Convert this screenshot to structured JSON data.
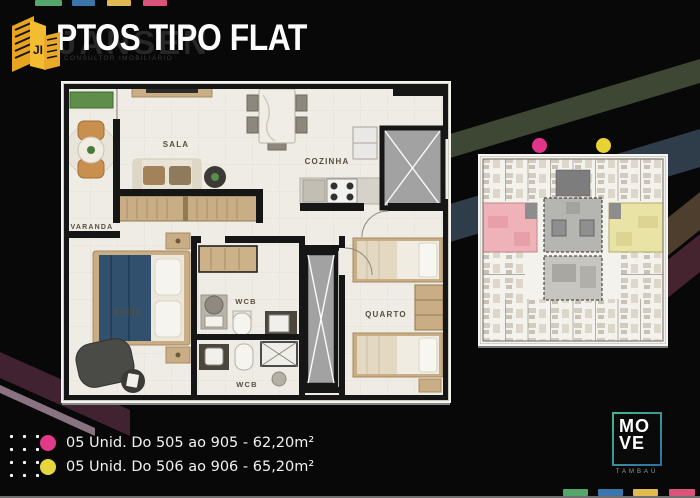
{
  "header": {
    "title": "PTOS TIPO FLAT",
    "watermark_name": "JANSEN",
    "watermark_subtitle": "CONSULTOR IMOBILIÁRIO",
    "logo_icon": "jansen-buildings-icon"
  },
  "floor_plan": {
    "rooms": {
      "varanda": "VARANDA",
      "sala": "SALA",
      "cozinha": "COZINHA",
      "suite": "SUÍTE",
      "wcb_suite": "WCB",
      "wcb_social": "WCB",
      "quarto": "QUARTO"
    }
  },
  "unit_plate": {
    "highlight_pink": "#eeb2b8",
    "highlight_yellow": "#e9e3a6"
  },
  "legend": {
    "items": [
      {
        "dot_color": "#e23a88",
        "label": "05 Unid. Do 505 ao 905 - 62,20m²"
      },
      {
        "dot_color": "#e6d83c",
        "label": "05 Unid. Do 506 ao 906 - 65,20m²"
      }
    ]
  },
  "plate_markers": {
    "pink_dot": "#e2358a",
    "yellow_dot": "#e8d334"
  },
  "move_logo": {
    "line1": "MO",
    "line2": "VE",
    "subtitle": "TAMBAÚ"
  },
  "palette": {
    "background": "#080808",
    "accent_green": "#55a66b",
    "accent_blue": "#3a76ab",
    "accent_yellow": "#dfba50",
    "accent_pink": "#d9537b",
    "stripe_olive": "#3e4734",
    "stripe_slate": "#2f3d4b",
    "stripe_brown": "#4e3e2d",
    "stripe_maroon": "#45242f",
    "stripe_mauve": "#8a7380"
  }
}
